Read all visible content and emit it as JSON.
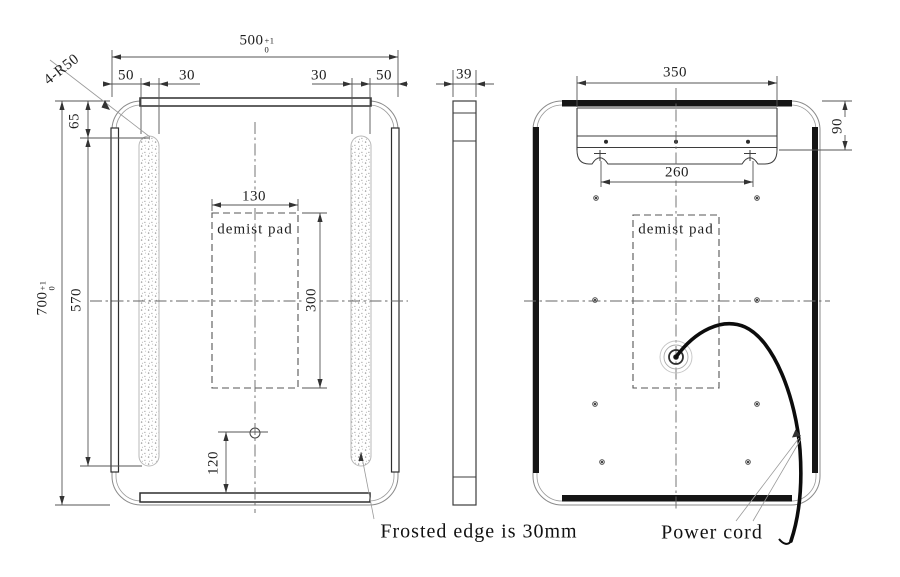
{
  "front_view": {
    "dim_width": {
      "value": "500",
      "tol_plus": "+1",
      "tol_minus": "0"
    },
    "dim_height": {
      "value": "700",
      "tol_plus": "+1",
      "tol_minus": "0"
    },
    "corner_radius_label": "4-R50",
    "dim_left_margin": "50",
    "dim_left_frost": "30",
    "dim_right_frost": "30",
    "dim_right_margin": "50",
    "dim_frost_top": "65",
    "dim_frost_length": "570",
    "dim_demist_width": "130",
    "dim_demist_height": "300",
    "dim_sensor_height": "120",
    "demist_label": "demist pad"
  },
  "side_view": {
    "dim_thickness": "39"
  },
  "back_view": {
    "dim_bracket_width": "350",
    "dim_hook_spacing": "260",
    "dim_bracket_offset": "90",
    "demist_label": "demist pad"
  },
  "notes": {
    "frosted_edge": "Frosted edge is 30mm",
    "power_cord": "Power cord"
  },
  "colors": {
    "outline": "#8a8a8a",
    "line_dark": "#2e2e2e",
    "dim_line": "#555555",
    "led_black": "#151515"
  }
}
